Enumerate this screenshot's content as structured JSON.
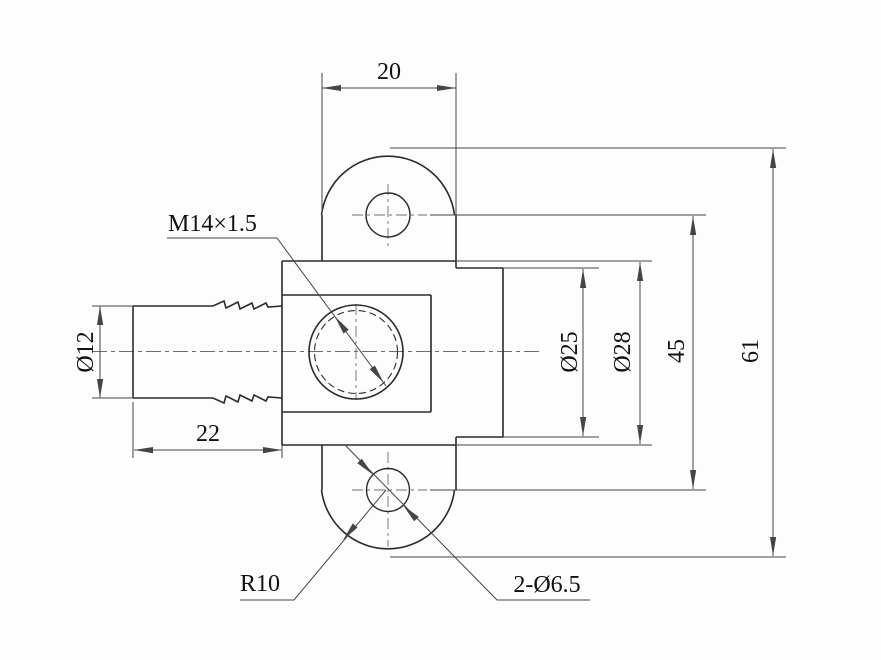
{
  "drawing": {
    "type": "engineering-drawing",
    "view": "side-view-mechanical-part",
    "dimensions": {
      "top_width": "20",
      "shaft_diameter": "Ø12",
      "shaft_length": "22",
      "thread_spec": "M14×1.5",
      "bore_diameter": "Ø25",
      "body_diameter": "Ø28",
      "hole_spacing": "45",
      "overall_height": "61",
      "lobe_radius": "R10",
      "mounting_holes": "2-Ø6.5"
    },
    "colors": {
      "background": "#fdfdfd",
      "outline": "#2b2b2b",
      "dimension_lines": "#454545",
      "centerlines": "#6e6e6e",
      "text": "#111111"
    }
  }
}
